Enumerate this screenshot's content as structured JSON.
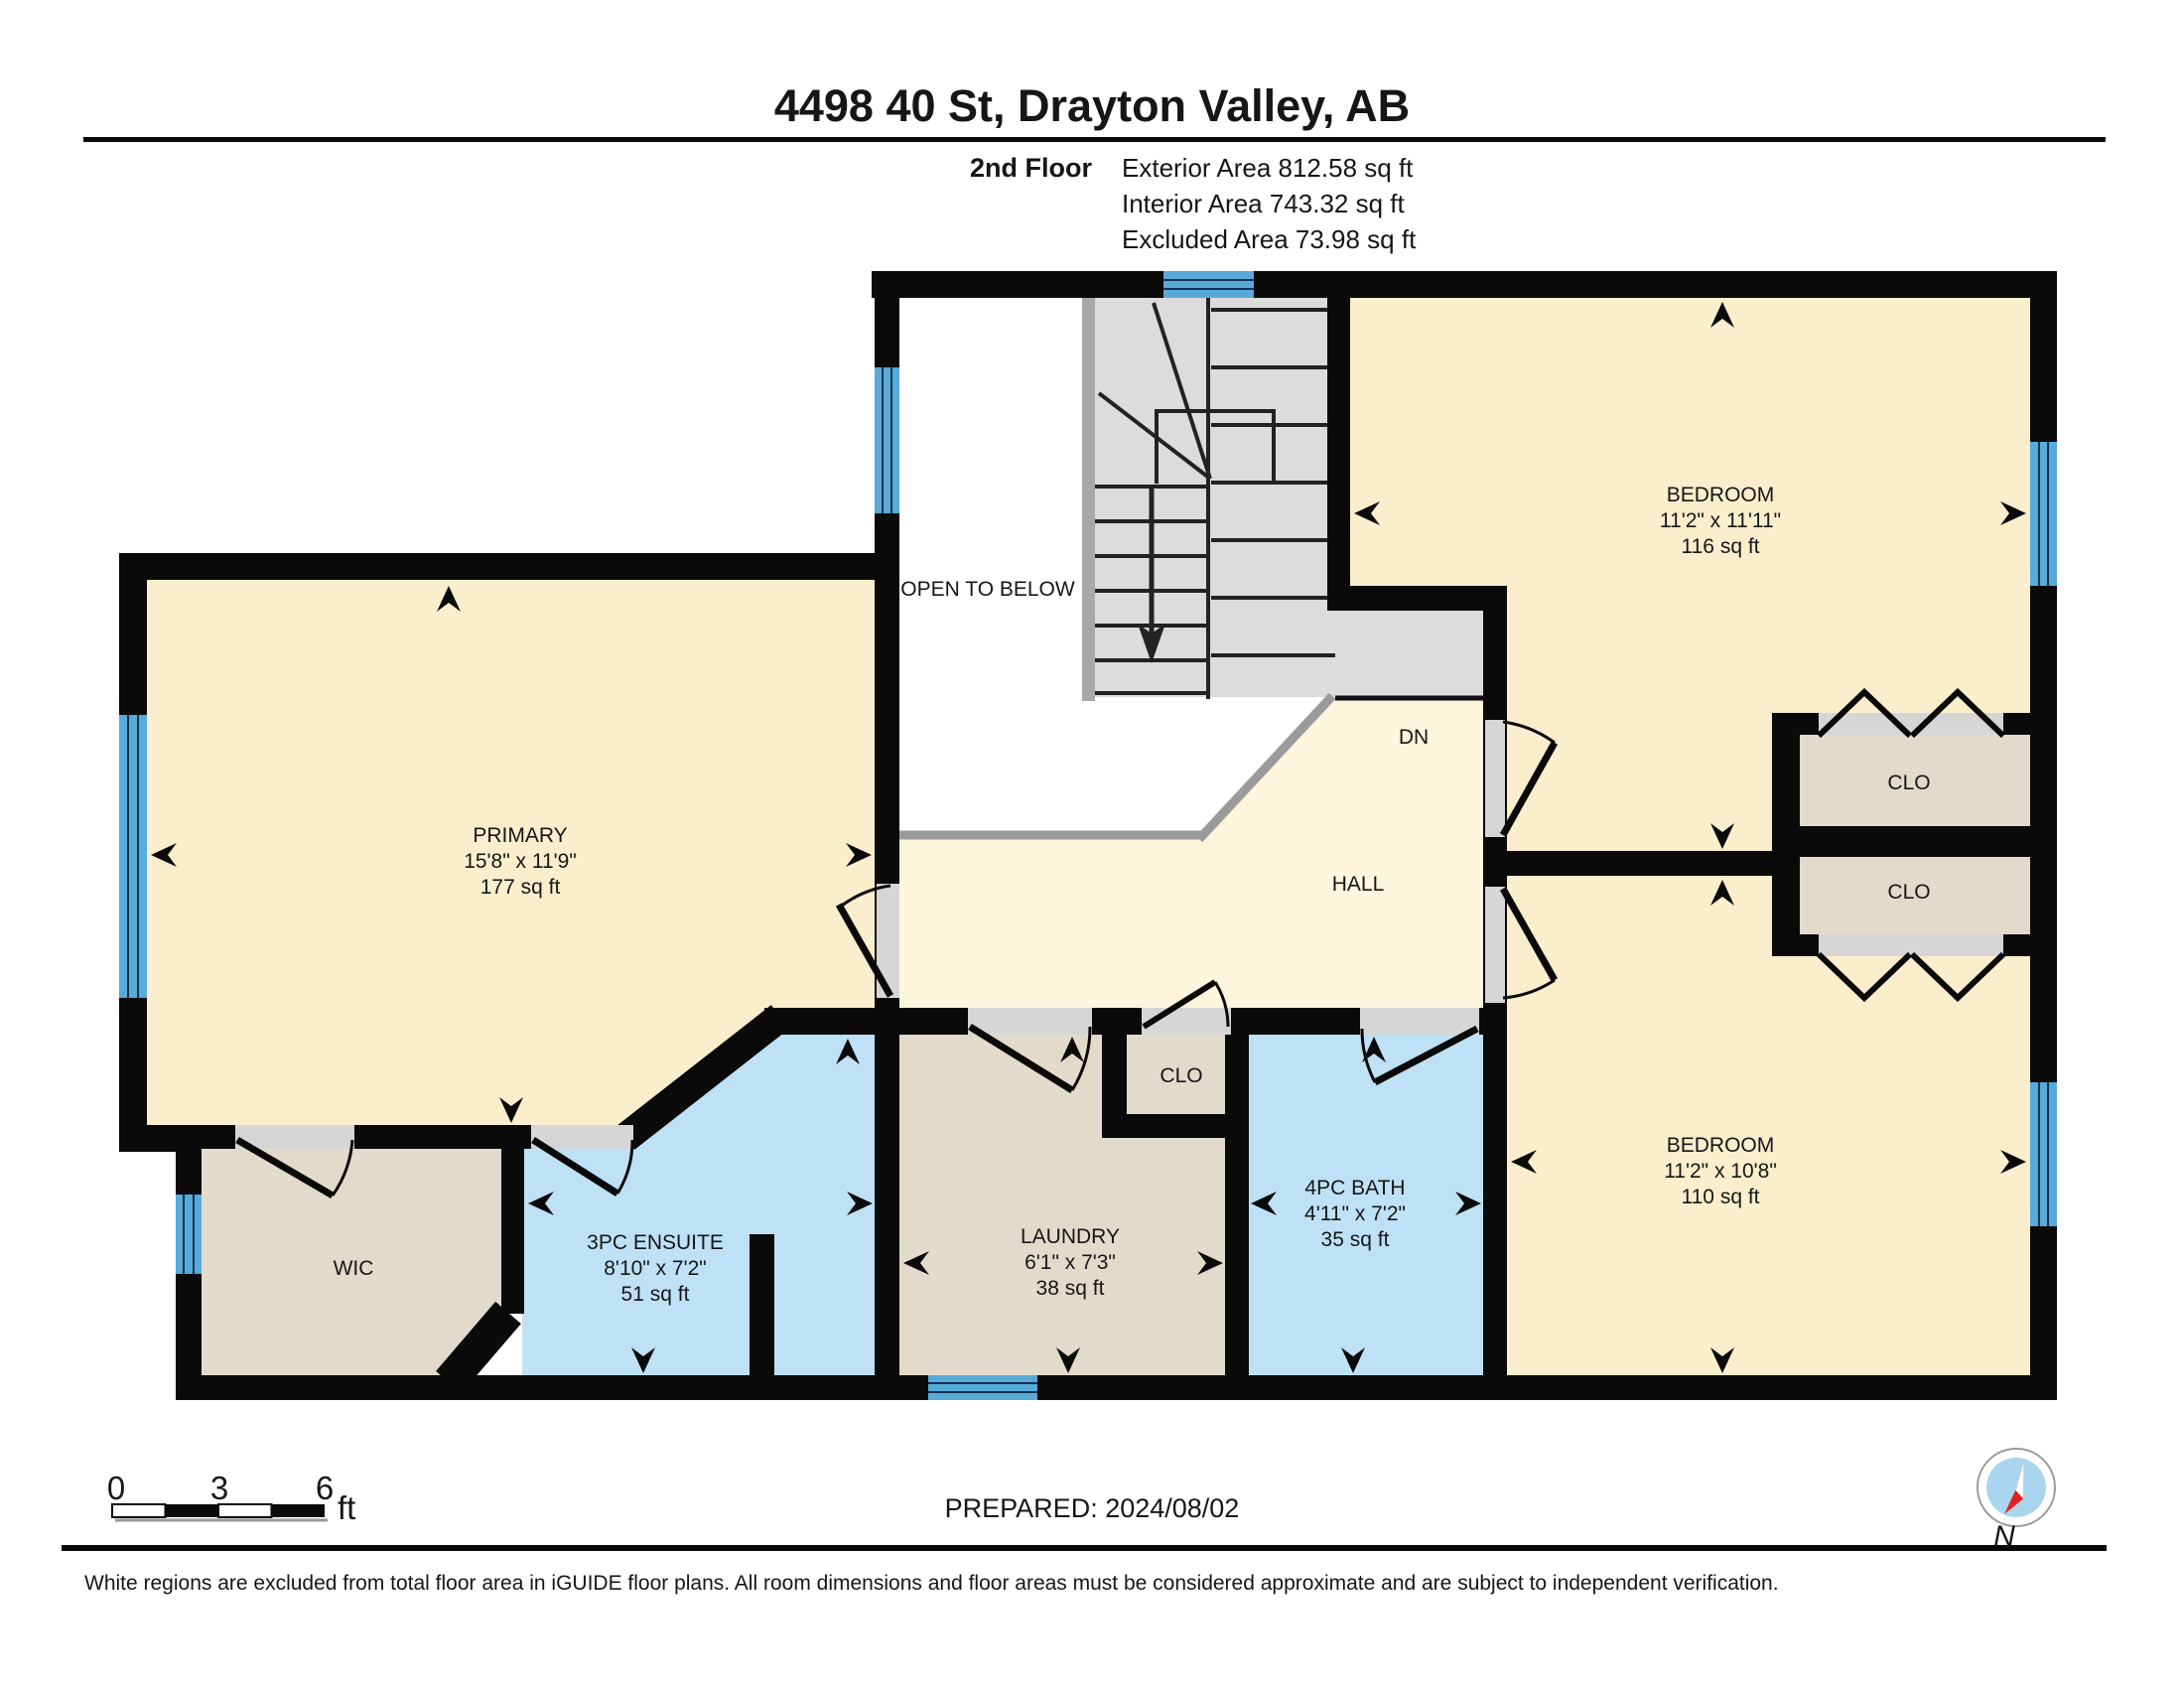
{
  "header": {
    "title": "4498 40 St, Drayton Valley, AB",
    "floor_label": "2nd Floor",
    "exterior_area": "Exterior Area 812.58 sq ft",
    "interior_area": "Interior Area 743.32 sq ft",
    "excluded_area": "Excluded Area 73.98 sq ft"
  },
  "rooms": {
    "primary": {
      "name": "PRIMARY",
      "dims": "15'8\" x 11'9\"",
      "area": "177 sq ft"
    },
    "bedroom_top": {
      "name": "BEDROOM",
      "dims": "11'2\" x 11'11\"",
      "area": "116 sq ft"
    },
    "bedroom_bottom": {
      "name": "BEDROOM",
      "dims": "11'2\" x 10'8\"",
      "area": "110 sq ft"
    },
    "ensuite": {
      "name": "3PC ENSUITE",
      "dims": "8'10\" x 7'2\"",
      "area": "51 sq ft"
    },
    "laundry": {
      "name": "LAUNDRY",
      "dims": "6'1\" x 7'3\"",
      "area": "38 sq ft"
    },
    "bath": {
      "name": "4PC BATH",
      "dims": "4'11\" x 7'2\"",
      "area": "35 sq ft"
    }
  },
  "labels": {
    "wic": "WIC",
    "closet_top": "CLO",
    "closet_bottom": "CLO",
    "closet_hall": "CLO",
    "hall": "HALL",
    "down": "DN",
    "open_to_below": "OPEN TO BELOW"
  },
  "footer": {
    "prepared": "PREPARED: 2024/08/02",
    "disclaimer": "White regions are excluded from total floor area in iGUIDE floor plans. All room dimensions and floor areas must be considered approximate and are subject to independent verification.",
    "scale": {
      "tick0": "0",
      "tick3": "3",
      "tick6": "6",
      "unit": "ft"
    },
    "compass_north": "N"
  },
  "colors": {
    "wall": "#0a0a0a",
    "room_beige": "#fbeecd",
    "hall_cream": "#fdf5dc",
    "room_blue": "#bfe1f6",
    "room_taupe": "#e2dbcb",
    "stair_gray": "#dcdcdc",
    "opening_gray": "#d6d6d6",
    "railing_gray": "#9a9a9a",
    "window_blue": "#58aad8",
    "compass_blue": "#aad5ef",
    "compass_red": "#e02222"
  }
}
